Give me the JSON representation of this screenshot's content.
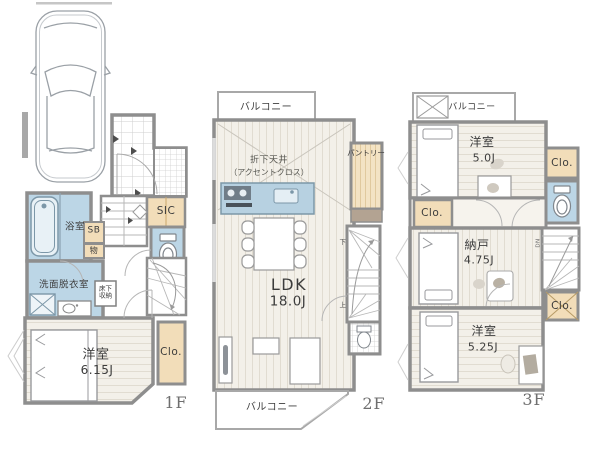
{
  "colors": {
    "wall": "#8e8e8e",
    "wet_area": "#bcd6e6",
    "closet_tan": "#f2ddb9",
    "flooring": "#f3f0e9",
    "kitchen_counter": "#b7d1e1"
  },
  "icons": {
    "car": "top-view sedan outline",
    "bathtub": "rounded tub",
    "toilet": "tank and bowl top view",
    "washing-machine": "square pan with X",
    "vanity": "counter with round sink",
    "stairs": "treads and winder fan",
    "bed": "mattress with pillow",
    "dining-table": "table with six chairs",
    "sofa": "L-shaped sofa blocks",
    "tv-board": "board with screen",
    "desk": "desk with chair pad",
    "balcony-box": "crossed storage box"
  },
  "floors": {
    "f1": {
      "label": "1F",
      "rooms": {
        "bath": "浴室",
        "sb": "SB",
        "mono": "物",
        "sic": "SIC",
        "wash": "洗面脱衣室",
        "underfloor1": "床下",
        "underfloor2": "収納",
        "west_name": "洋室",
        "west_size": "6.15J",
        "closet": "Clo."
      }
    },
    "f2": {
      "label": "2F",
      "rooms": {
        "balcony_top": "バルコニー",
        "balcony_bottom": "バルコニー",
        "ceiling1": "折下天井",
        "ceiling2": "（アクセントクロス）",
        "pantry": "パントリー",
        "ldk_name": "LDK",
        "ldk_size": "18.0J",
        "stairs_down": "下",
        "stairs_up": "上"
      }
    },
    "f3": {
      "label": "3F",
      "rooms": {
        "balcony": "バルコニー",
        "west1_name": "洋室",
        "west1_size": "5.0J",
        "closet1": "Clo.",
        "closet2": "Clo.",
        "closet3": "Clo.",
        "storage_name": "納戸",
        "storage_size": "4.75J",
        "west2_name": "洋室",
        "west2_size": "5.25J",
        "stairs_dn": "DN"
      }
    }
  }
}
